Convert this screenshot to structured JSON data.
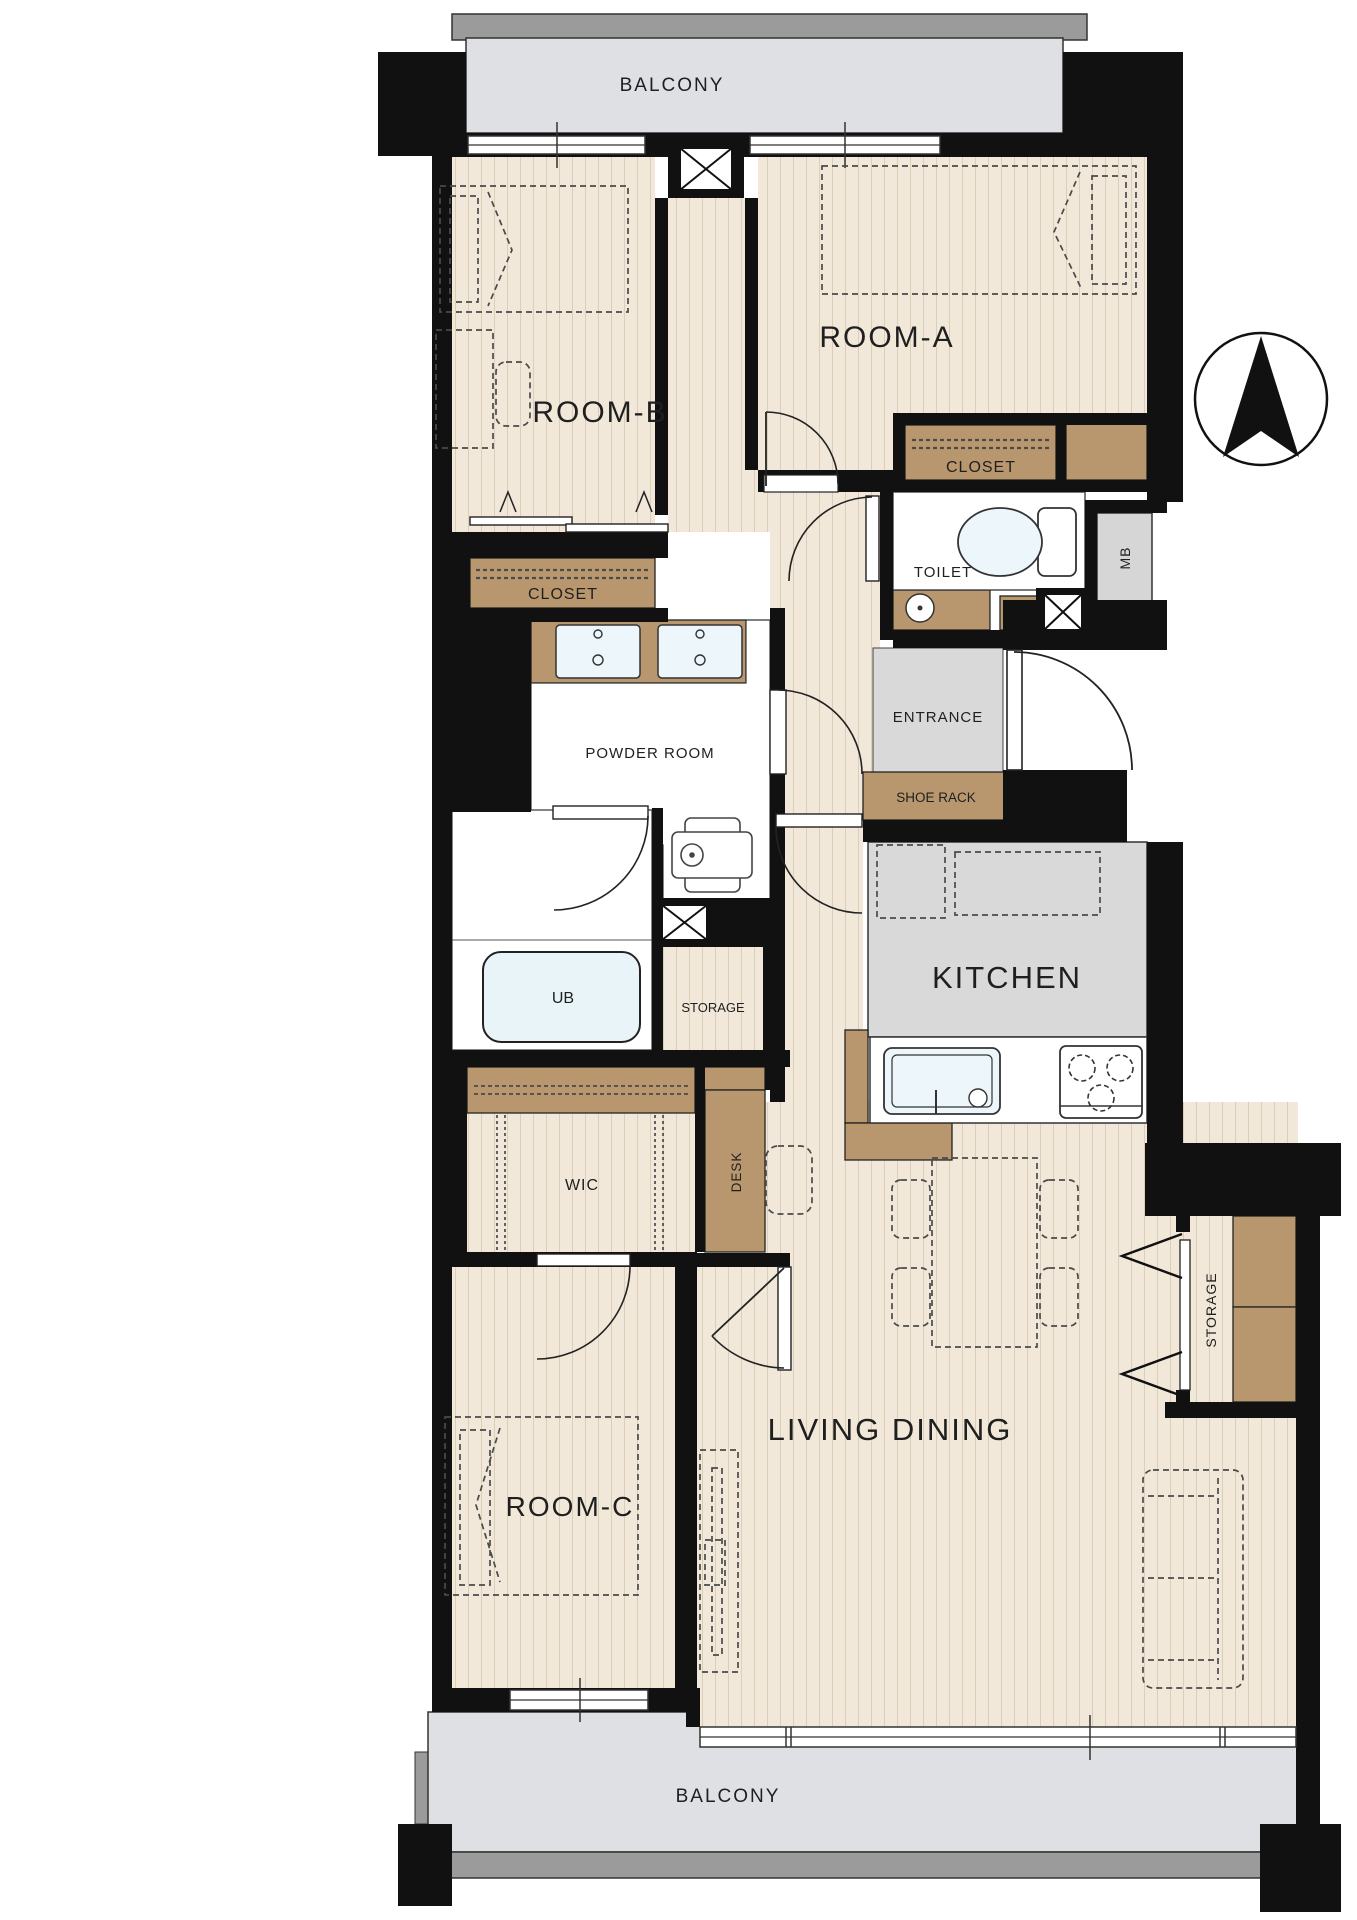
{
  "document": {
    "type": "apartment-floor-plan",
    "orientation": "north-up"
  },
  "labels": {
    "balcony_top": "BALCONY",
    "room_a": "ROOM-A",
    "room_b": "ROOM-B",
    "closet_room_a": "CLOSET",
    "closet_room_b": "CLOSET",
    "toilet": "TOILET",
    "mb": "MB",
    "entrance": "ENTRANCE",
    "shoe_rack": "SHOE RACK",
    "powder_room": "POWDER ROOM",
    "ub": "UB",
    "storage_hall": "STORAGE",
    "kitchen": "KITCHEN",
    "wic": "WIC",
    "desk": "DESK",
    "room_c": "ROOM-C",
    "living_dining": "LIVING  DINING",
    "storage_living": "STORAGE",
    "balcony_bottom": "BALCONY"
  },
  "colors": {
    "wall": "#111111",
    "floor_base": "#F1E8D9",
    "floor_stripe": "#DCCFB9",
    "wood": "#B9976E",
    "gray_room": "#D9D9D9",
    "balcony": "#DEE0E4",
    "railing": "#9B9B9B",
    "bath_blue": "#E9F4F8",
    "outline": "#333333"
  },
  "icons": {
    "compass": "north-arrow-icon",
    "shaft": "pipe-shaft-x-icon",
    "toilet": "toilet-fixture-icon",
    "bathtub": "bathtub-icon",
    "washer": "washing-machine-icon",
    "sink": "kitchen-sink-icon",
    "stove": "gas-stove-icon"
  }
}
